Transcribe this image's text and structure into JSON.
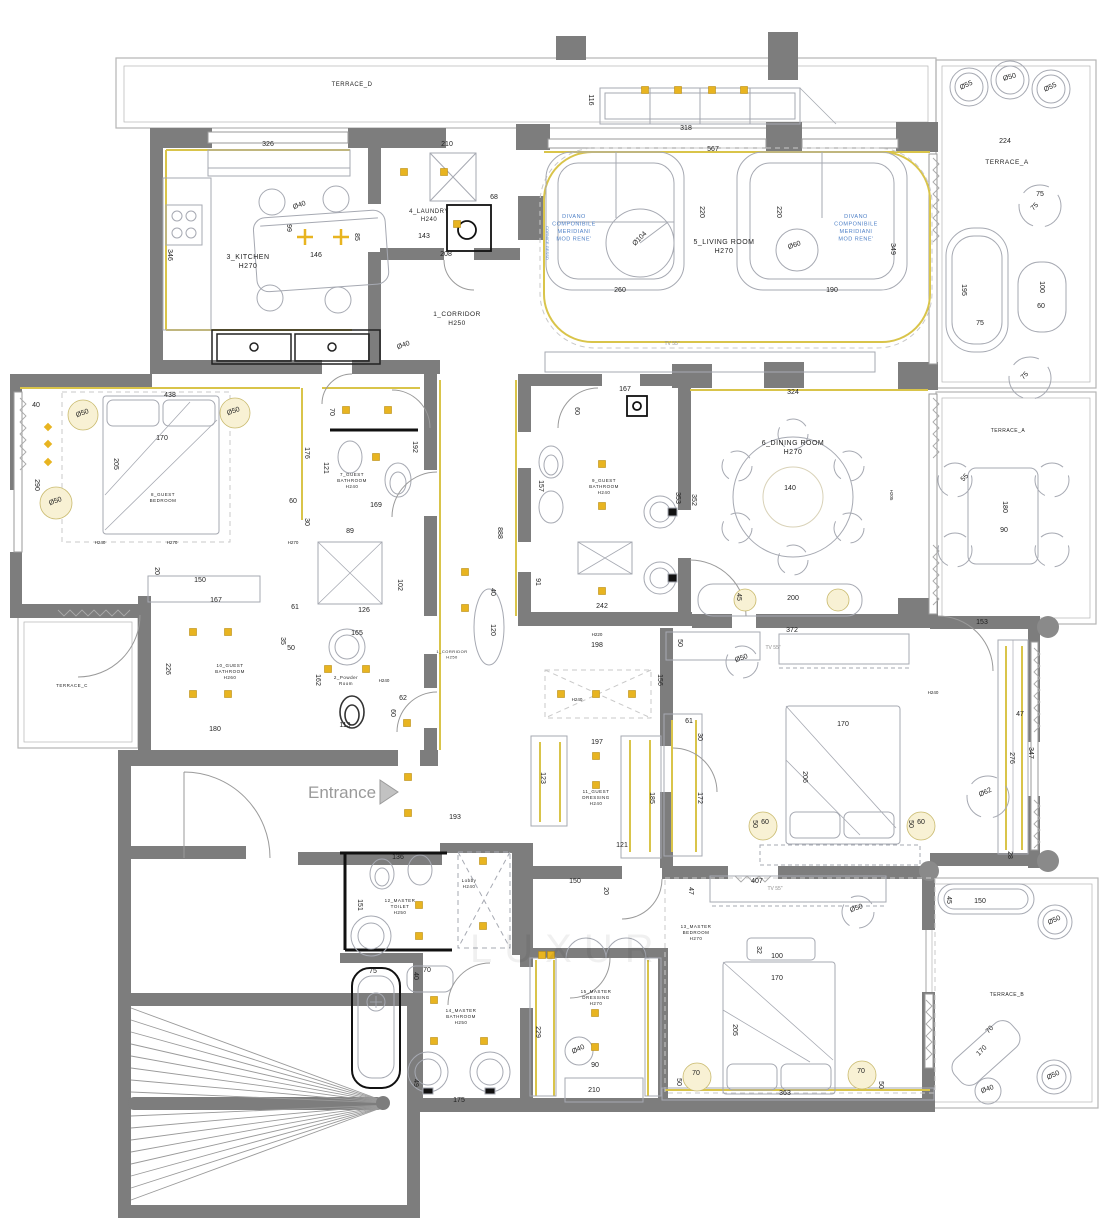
{
  "meta": {
    "title": "Apartment floor plan with furniture, dimensions and ceiling lighting"
  },
  "entrance": {
    "label": "Entrance"
  },
  "watermark": {
    "text": "LUXUR"
  },
  "colors": {
    "wall": "#7d7d7d",
    "furniture_line": "#a6a9b2",
    "accent_yellow": "#d9c44a",
    "spotlight_gold": "#e8b420",
    "glow_fill": "#f8f1d4",
    "dim_text": "#1f1f1f",
    "note_blue": "#4f81c7",
    "entrance_gray": "#9a9a9a"
  },
  "plan": {
    "rooms": [
      {
        "id": "terrace-d",
        "lines": [
          "TERRACE_D"
        ],
        "x": 352,
        "y": 86,
        "s": 6,
        "lh": 8
      },
      {
        "id": "terrace-a-top",
        "lines": [
          "TERRACE_A"
        ],
        "x": 1007,
        "y": 164,
        "s": 6.5,
        "lh": 8
      },
      {
        "id": "terrace-a-mid",
        "lines": [
          "TERRACE_A"
        ],
        "x": 1008,
        "y": 432,
        "s": 5,
        "lh": 7
      },
      {
        "id": "terrace-b",
        "lines": [
          "TERRACE_B"
        ],
        "x": 1007,
        "y": 996,
        "s": 5,
        "lh": 7
      },
      {
        "id": "terrace-c",
        "lines": [
          "TERRACE_C"
        ],
        "x": 72,
        "y": 687,
        "s": 4.5,
        "lh": 6
      },
      {
        "id": "kitchen",
        "lines": [
          "3_KITCHEN",
          "H270"
        ],
        "x": 248,
        "y": 259,
        "s": 7,
        "lh": 9
      },
      {
        "id": "laundry",
        "lines": [
          "4_LAUNDRY",
          "H240"
        ],
        "x": 429,
        "y": 213,
        "s": 6,
        "lh": 8
      },
      {
        "id": "corridor",
        "lines": [
          "1_CORRIDOR",
          "H250"
        ],
        "x": 457,
        "y": 316,
        "s": 6.5,
        "lh": 9
      },
      {
        "id": "corridor-2",
        "lines": [
          "1_CORRIDOR",
          "H250"
        ],
        "x": 452,
        "y": 653,
        "s": 4,
        "lh": 5.5
      },
      {
        "id": "living-room",
        "lines": [
          "5_LIVING ROOM",
          "H270"
        ],
        "x": 724,
        "y": 244,
        "s": 7,
        "lh": 9
      },
      {
        "id": "dining-room",
        "lines": [
          "6_DINING ROOM",
          "H270"
        ],
        "x": 793,
        "y": 445,
        "s": 7,
        "lh": 9
      },
      {
        "id": "guest-bathroom-7",
        "lines": [
          "7_GUEST",
          "BATHROOM",
          "H240"
        ],
        "x": 352,
        "y": 476,
        "s": 4.5,
        "lh": 6
      },
      {
        "id": "guest-bedroom-8",
        "lines": [
          "8_GUEST",
          "BEDROOM"
        ],
        "x": 163,
        "y": 496,
        "s": 4.5,
        "lh": 6
      },
      {
        "id": "guest-bathroom-9",
        "lines": [
          "9_GUEST",
          "BATHROOM",
          "H240"
        ],
        "x": 604,
        "y": 482,
        "s": 4.5,
        "lh": 6
      },
      {
        "id": "guest-bathroom-10",
        "lines": [
          "10_GUEST",
          "BATHROOM",
          "H260"
        ],
        "x": 230,
        "y": 667,
        "s": 4.5,
        "lh": 6
      },
      {
        "id": "powder-room",
        "lines": [
          "2_Powder",
          "Room"
        ],
        "x": 346,
        "y": 679,
        "s": 4.5,
        "lh": 6
      },
      {
        "id": "guest-dressing-11",
        "lines": [
          "11_GUEST",
          "DRESSING",
          "H240"
        ],
        "x": 596,
        "y": 793,
        "s": 4.5,
        "lh": 6
      },
      {
        "id": "master-toilet-12",
        "lines": [
          "12_MASTER",
          "TOILET",
          "H250"
        ],
        "x": 400,
        "y": 902,
        "s": 4.5,
        "lh": 6
      },
      {
        "id": "lobby",
        "lines": [
          "Lobby",
          "H240"
        ],
        "x": 469,
        "y": 882,
        "s": 4.5,
        "lh": 6
      },
      {
        "id": "master-bathroom-14",
        "lines": [
          "14_MASTER",
          "BATHROOM",
          "H250"
        ],
        "x": 461,
        "y": 1012,
        "s": 4.5,
        "lh": 6
      },
      {
        "id": "master-dressing-15",
        "lines": [
          "15_MASTER",
          "DRESSING",
          "H270"
        ],
        "x": 596,
        "y": 993,
        "s": 4.5,
        "lh": 6
      },
      {
        "id": "master-bedroom-13",
        "lines": [
          "13_MASTER",
          "BEDROOM",
          "H270"
        ],
        "x": 696,
        "y": 928,
        "s": 4.5,
        "lh": 6
      },
      {
        "id": "sofa-note-left",
        "lines": [
          "DIVANO",
          "COMPONIBILE",
          "MERIDIANI",
          "MOD RENE'"
        ],
        "x": 574,
        "y": 218,
        "s": 5.5,
        "lh": 7.5,
        "c": "b"
      },
      {
        "id": "sofa-note-right",
        "lines": [
          "DIVANO",
          "COMPONIBILE",
          "MERIDIANI",
          "MOD RENE'"
        ],
        "x": 856,
        "y": 218,
        "s": 5.5,
        "lh": 7.5,
        "c": "b"
      }
    ],
    "dimensions": [
      [
        "326",
        268,
        146
      ],
      [
        "210",
        447,
        146
      ],
      [
        "68",
        494,
        199
      ],
      [
        "143",
        424,
        238
      ],
      [
        "208",
        446,
        256
      ],
      [
        "99",
        287,
        228,
        90
      ],
      [
        "85",
        355,
        237,
        90
      ],
      [
        "Ø40",
        300,
        207,
        -20
      ],
      [
        "146",
        316,
        257
      ],
      [
        "346",
        168,
        255,
        90
      ],
      [
        "Ø40",
        404,
        347,
        -20
      ],
      [
        "318",
        686,
        130
      ],
      [
        "116",
        589,
        100,
        90
      ],
      [
        "567",
        713,
        151
      ],
      [
        "220",
        700,
        212,
        90
      ],
      [
        "220",
        777,
        212,
        90
      ],
      [
        "Ø104",
        641,
        240,
        -45
      ],
      [
        "Ø60",
        795,
        247,
        -20
      ],
      [
        "260",
        620,
        292
      ],
      [
        "190",
        832,
        292
      ],
      [
        "349",
        891,
        249,
        90
      ],
      [
        "224",
        1005,
        143
      ],
      [
        "Ø55",
        967,
        87,
        -25
      ],
      [
        "Ø50",
        1010,
        79,
        -15
      ],
      [
        "Ø55",
        1051,
        89,
        -25
      ],
      [
        "75",
        1040,
        196
      ],
      [
        "75",
        1036,
        208,
        -45
      ],
      [
        "195",
        962,
        290,
        90
      ],
      [
        "100",
        1040,
        287,
        90
      ],
      [
        "60",
        1041,
        308
      ],
      [
        "75",
        980,
        325
      ],
      [
        "75",
        1026,
        377,
        -45
      ],
      [
        "324",
        793,
        394
      ],
      [
        "352",
        692,
        500,
        90
      ],
      [
        "353",
        676,
        498,
        90
      ],
      [
        "140",
        790,
        490
      ],
      [
        "45",
        737,
        597,
        90
      ],
      [
        "200",
        793,
        600
      ],
      [
        "372",
        792,
        632
      ],
      [
        "153",
        982,
        624
      ],
      [
        "55",
        966,
        479,
        -45
      ],
      [
        "180",
        1003,
        507,
        90
      ],
      [
        "90",
        1004,
        532
      ],
      [
        "438",
        170,
        397
      ],
      [
        "40",
        36,
        407
      ],
      [
        "170",
        162,
        440
      ],
      [
        "205",
        114,
        464,
        90
      ],
      [
        "290",
        35,
        485,
        90
      ],
      [
        "Ø50",
        83,
        415,
        -20
      ],
      [
        "Ø50",
        234,
        413,
        -20
      ],
      [
        "Ø50",
        56,
        503,
        -20
      ],
      [
        "176",
        305,
        453,
        90
      ],
      [
        "60",
        293,
        503
      ],
      [
        "30",
        305,
        522,
        90
      ],
      [
        "20",
        155,
        571,
        90
      ],
      [
        "150",
        200,
        582
      ],
      [
        "70",
        330,
        412,
        90
      ],
      [
        "192",
        413,
        447,
        90
      ],
      [
        "121",
        324,
        468,
        90
      ],
      [
        "169",
        376,
        507
      ],
      [
        "89",
        350,
        533
      ],
      [
        "102",
        398,
        585,
        90
      ],
      [
        "126",
        364,
        612
      ],
      [
        "61",
        295,
        609
      ],
      [
        "167",
        216,
        602
      ],
      [
        "165",
        357,
        635
      ],
      [
        "35",
        281,
        641,
        90
      ],
      [
        "50",
        291,
        650
      ],
      [
        "162",
        316,
        680,
        90
      ],
      [
        "226",
        166,
        669,
        90
      ],
      [
        "180",
        215,
        731
      ],
      [
        "113",
        345,
        727
      ],
      [
        "60",
        391,
        713,
        90
      ],
      [
        "62",
        403,
        700
      ],
      [
        "193",
        455,
        819
      ],
      [
        "136",
        398,
        859
      ],
      [
        "167",
        625,
        391
      ],
      [
        "60",
        575,
        411,
        90
      ],
      [
        "157",
        539,
        486,
        90
      ],
      [
        "242",
        602,
        608
      ],
      [
        "91",
        536,
        582,
        90
      ],
      [
        "888",
        498,
        533,
        90
      ],
      [
        "40",
        491,
        592,
        90
      ],
      [
        "120",
        491,
        630,
        90
      ],
      [
        "198",
        597,
        647
      ],
      [
        "50",
        678,
        643,
        90
      ],
      [
        "156",
        658,
        680,
        90
      ],
      [
        "197",
        597,
        744
      ],
      [
        "123",
        541,
        778,
        90
      ],
      [
        "185",
        650,
        798,
        90
      ],
      [
        "121",
        622,
        847
      ],
      [
        "61",
        689,
        723
      ],
      [
        "30",
        698,
        737,
        90
      ],
      [
        "172",
        698,
        798,
        90
      ],
      [
        "Ø50",
        742,
        660,
        -20
      ],
      [
        "170",
        843,
        726
      ],
      [
        "206",
        803,
        777,
        90
      ],
      [
        "50",
        753,
        824,
        90
      ],
      [
        "60",
        765,
        824
      ],
      [
        "50",
        909,
        824,
        90
      ],
      [
        "60",
        921,
        824
      ],
      [
        "28",
        1008,
        855,
        90
      ],
      [
        "47",
        1020,
        716
      ],
      [
        "276",
        1010,
        758,
        90
      ],
      [
        "347",
        1029,
        753,
        90
      ],
      [
        "Ø62",
        986,
        794,
        -25
      ],
      [
        "151",
        358,
        905,
        90
      ],
      [
        "75",
        373,
        973
      ],
      [
        "70",
        427,
        972
      ],
      [
        "40",
        414,
        976,
        90
      ],
      [
        "49",
        414,
        1083,
        90
      ],
      [
        "175",
        459,
        1102
      ],
      [
        "229",
        536,
        1032,
        90
      ],
      [
        "Ø40",
        579,
        1051,
        -25
      ],
      [
        "90",
        595,
        1067
      ],
      [
        "210",
        594,
        1092
      ],
      [
        "150",
        575,
        883
      ],
      [
        "20",
        604,
        891,
        90
      ],
      [
        "407",
        757,
        883
      ],
      [
        "47",
        689,
        891,
        90
      ],
      [
        "Ø50",
        857,
        910,
        -20
      ],
      [
        "32",
        757,
        950,
        90
      ],
      [
        "100",
        777,
        958
      ],
      [
        "170",
        777,
        980
      ],
      [
        "205",
        733,
        1030,
        90
      ],
      [
        "70",
        696,
        1075
      ],
      [
        "50",
        677,
        1082,
        90
      ],
      [
        "70",
        861,
        1073
      ],
      [
        "50",
        879,
        1085,
        90
      ],
      [
        "363",
        785,
        1095
      ],
      [
        "45",
        947,
        900,
        90
      ],
      [
        "150",
        980,
        903
      ],
      [
        "Ø50",
        1055,
        922,
        -25
      ],
      [
        "70",
        991,
        1031,
        -45
      ],
      [
        "170",
        983,
        1052,
        -45
      ],
      [
        "Ø40",
        988,
        1091,
        -20
      ],
      [
        "Ø50",
        1054,
        1077,
        -25
      ],
      [
        "H240",
        100,
        544,
        0,
        4.5
      ],
      [
        "H270",
        172,
        544,
        0,
        4.5
      ],
      [
        "H270",
        293,
        544,
        0,
        4.5
      ],
      [
        "H205",
        890,
        495,
        90,
        4.5
      ],
      [
        "H240",
        933,
        694,
        0,
        4.5
      ],
      [
        "H220",
        597,
        636,
        0,
        4.5
      ],
      [
        "H240",
        577,
        701,
        0,
        4.5
      ],
      [
        "H240",
        384,
        682,
        0,
        4.5
      ],
      [
        "TV 55\"",
        672,
        345,
        0,
        5,
        "g"
      ],
      [
        "TV 55\"",
        773,
        649,
        0,
        5,
        "g"
      ],
      [
        "TV 55\"",
        775,
        890,
        0,
        5,
        "g"
      ],
      [
        "CORNICE GESSO",
        546,
        243,
        90,
        4,
        "b"
      ]
    ],
    "lights": {
      "spotlights": [
        [
          404,
          172
        ],
        [
          444,
          172
        ],
        [
          457,
          224
        ],
        [
          645,
          90
        ],
        [
          678,
          90
        ],
        [
          712,
          90
        ],
        [
          744,
          90
        ],
        [
          346,
          410
        ],
        [
          388,
          410
        ],
        [
          376,
          457
        ],
        [
          602,
          464
        ],
        [
          602,
          506
        ],
        [
          602,
          591
        ],
        [
          561,
          694
        ],
        [
          596,
          694
        ],
        [
          632,
          694
        ],
        [
          596,
          756
        ],
        [
          596,
          785
        ],
        [
          193,
          632
        ],
        [
          228,
          632
        ],
        [
          193,
          694
        ],
        [
          228,
          694
        ],
        [
          328,
          669
        ],
        [
          366,
          669
        ],
        [
          407,
          723
        ],
        [
          408,
          777
        ],
        [
          408,
          813
        ],
        [
          465,
          572
        ],
        [
          465,
          608
        ],
        [
          419,
          905
        ],
        [
          419,
          936
        ],
        [
          483,
          861
        ],
        [
          483,
          926
        ],
        [
          434,
          1000
        ],
        [
          434,
          1041
        ],
        [
          484,
          1041
        ],
        [
          595,
          1013
        ],
        [
          595,
          1047
        ],
        [
          542,
          955
        ],
        [
          551,
          955
        ]
      ],
      "diamonds": [
        [
          48,
          427
        ],
        [
          48,
          444
        ],
        [
          48,
          462
        ]
      ],
      "crosses": [
        [
          305,
          237
        ],
        [
          341,
          237
        ]
      ],
      "glows": [
        [
          83,
          415,
          15
        ],
        [
          235,
          413,
          15
        ],
        [
          56,
          503,
          16
        ],
        [
          745,
          600,
          11
        ],
        [
          838,
          600,
          11
        ],
        [
          763,
          826,
          14
        ],
        [
          921,
          826,
          14
        ],
        [
          697,
          1077,
          14
        ],
        [
          862,
          1075,
          14
        ]
      ]
    }
  }
}
